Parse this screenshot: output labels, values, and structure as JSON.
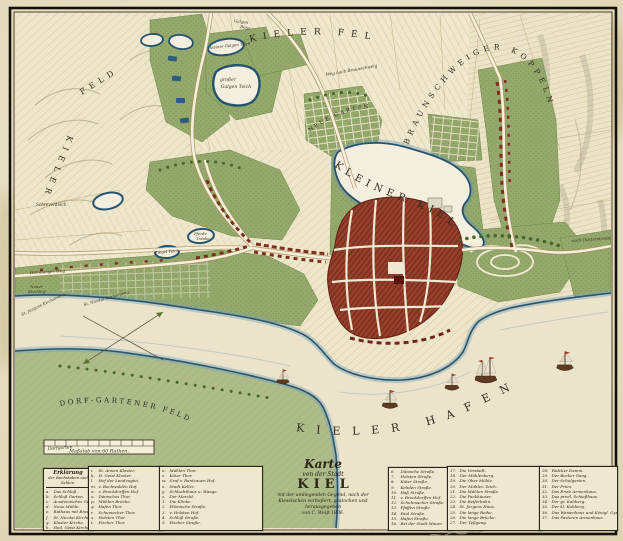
{
  "palette": {
    "paper": "#e7dfc2",
    "field": "#eee6cb",
    "green": "#95a96c",
    "water_rim": "#27556e",
    "water_glow": "#7ea4b8",
    "town_red": "#8c3a28",
    "road": "#f5efdb",
    "ink": "#2b2418"
  },
  "map_labels": {
    "kieler_feld": "KIELER FELD",
    "feld_west": "FELD",
    "kieler_west": "KIELER",
    "braunschweiger_koppeln": "BRAUNSCHWEIGER KOPPELN",
    "kleiner_kiel": "KLEINER KIEL",
    "kieler_hafen": "KIELER HAFEN",
    "dorf_gartener_feld": "DORF-GARTENER FELD",
    "neue_garten": "NEUE GARTEN",
    "grosser_galgen_teich_1": "großer",
    "grosser_galgen_teich_2": "Galgen Teich",
    "kleiner_galgen_teich": "kleiner Galgen Teich",
    "galgen_berg_1": "Galgen",
    "galgen_berg_2": "Berg",
    "schreventeich": "Schreventeich",
    "ziegel_teich": "Ziegel Teich",
    "pferde_traenke_1": "Pferde",
    "pferde_traenke_2": "Tränke",
    "hamburger_weg": "Hamburger Weg",
    "neuer_kirchhof_1": "Neuer",
    "neuer_kirchhof_2": "Kirchhof",
    "st_juergens_kirchenweg": "St. Jürgens Kirchenweg",
    "st_nicolai_kirchenweg": "St. Nicolai Kirchenweg",
    "weg_nach_braunschweig": "Weg nach Braunschweig",
    "nach_duesternbrook": "nach Düsternbrook",
    "dorfgarten": "Dorfgarten",
    "scale_bar": "Maßstab von 60 Ruthen."
  },
  "cartouche": {
    "l1": "Karte",
    "l2": "von der Stadt",
    "l3": "KIEL",
    "l4": "mit der umliegenden Gegend, nach der",
    "l5": "Kieselschen verbeßert, gestochen und herausgegeben",
    "l6": "von C. Weiß 1806."
  },
  "legend": {
    "heading1": "Erklärung",
    "heading2": "der Buchstaben und Zahlen.",
    "col1": [
      {
        "k": "a.",
        "v": "Das Schloß."
      },
      {
        "k": "b.",
        "v": "Schloß Garten."
      },
      {
        "k": "c.",
        "v": "Academisches Gebäude."
      },
      {
        "k": "d.",
        "v": "Neue Mühle."
      },
      {
        "k": "e.",
        "v": "Rathaus mit Brauhaus."
      },
      {
        "k": "f.",
        "v": "St. Nicolai Kirche."
      },
      {
        "k": "g.",
        "v": "Kloster Kirche."
      },
      {
        "k": "h.",
        "v": "Heil. Geist Kirche."
      }
    ],
    "col2": [
      {
        "k": "i.",
        "v": "St. Annen Kloster."
      },
      {
        "k": "k.",
        "v": "H. Geist Kloster."
      },
      {
        "k": "l.",
        "v": "Hof der Landvogtei."
      },
      {
        "k": "m.",
        "v": "v. Buchwalden Hof."
      },
      {
        "k": "n.",
        "v": "v. Brockdorffen Hof."
      },
      {
        "k": "o.",
        "v": "Dänisches Thor."
      },
      {
        "k": "p.",
        "v": "Mühlen Brücke."
      },
      {
        "k": "q.",
        "v": "Hafen Thor."
      },
      {
        "k": "r.",
        "v": "Schumacher Thor."
      },
      {
        "k": "s.",
        "v": "Holsten Thor."
      },
      {
        "k": "t.",
        "v": "Fischer Thor."
      }
    ],
    "col3": [
      {
        "k": "u.",
        "v": "Mühlen Thor."
      },
      {
        "k": "v.",
        "v": "Küter Thor."
      },
      {
        "k": "w.",
        "v": "Graf v. Rantzauen Hof."
      },
      {
        "k": "x.",
        "v": "Stadt Keller."
      },
      {
        "k": "y.",
        "v": "Schlachthaus u. Waage."
      },
      {
        "k": "z.",
        "v": "Der Marckt."
      },
      {
        "k": "1.",
        "v": "Die Klinke."
      },
      {
        "k": "2.",
        "v": "Flämische Straße."
      },
      {
        "k": "3.",
        "v": "v. Holsten Hof."
      },
      {
        "k": "4.",
        "v": "Schloß Straße."
      },
      {
        "k": "5.",
        "v": "Fischer Straße."
      }
    ],
    "col4": [
      {
        "k": "6.",
        "v": "Dänische Straße."
      },
      {
        "k": "7.",
        "v": "Holsten Straße."
      },
      {
        "k": "8.",
        "v": "Küter Straße."
      },
      {
        "k": "9.",
        "v": "Kehden Straße."
      },
      {
        "k": "10.",
        "v": "Haß Straße."
      },
      {
        "k": "11.",
        "v": "v. Brockdorffen Hof."
      },
      {
        "k": "12.",
        "v": "Schuhmacher Straße."
      },
      {
        "k": "13.",
        "v": "Pfaffen Straße."
      },
      {
        "k": "14.",
        "v": "Faul Straße."
      },
      {
        "k": "15.",
        "v": "Hafen Straße."
      },
      {
        "k": "16.",
        "v": "Bei der Stadt Mauer."
      }
    ],
    "col5": [
      {
        "k": "17.",
        "v": "Die Vorstadt."
      },
      {
        "k": "18.",
        "v": "Der Mühlenberg."
      },
      {
        "k": "19.",
        "v": "Die Ober Mühle."
      },
      {
        "k": "20.",
        "v": "Der Mühlen Teich."
      },
      {
        "k": "21.",
        "v": "Die Mühlen Straße."
      },
      {
        "k": "22.",
        "v": "Die Packhäuser."
      },
      {
        "k": "23.",
        "v": "Die Reiferbahn."
      },
      {
        "k": "24.",
        "v": "St. Jürgens Haus."
      },
      {
        "k": "25.",
        "v": "Die lange Reihe."
      },
      {
        "k": "26.",
        "v": "Die lange Brücke."
      },
      {
        "k": "27.",
        "v": "Der Teßgang."
      }
    ],
    "col6": [
      {
        "k": "28.",
        "v": "Walcker Damm."
      },
      {
        "k": "29.",
        "v": "Der Becker Gang."
      },
      {
        "k": "30.",
        "v": "Der Schulgarten."
      },
      {
        "k": "31.",
        "v": "Der Prien."
      },
      {
        "k": "32.",
        "v": "Das Erste Armenhaus."
      },
      {
        "k": "33.",
        "v": "Das privil. Schießhaus."
      },
      {
        "k": "34.",
        "v": "Der gr. Kuhberg."
      },
      {
        "k": "35.",
        "v": "Der kl. Kuhberg."
      },
      {
        "k": "36.",
        "v": "Das Waisenhaus und Königl. Gymnasium."
      },
      {
        "k": "37.",
        "v": "Das Pastoren Armenhaus."
      }
    ]
  }
}
